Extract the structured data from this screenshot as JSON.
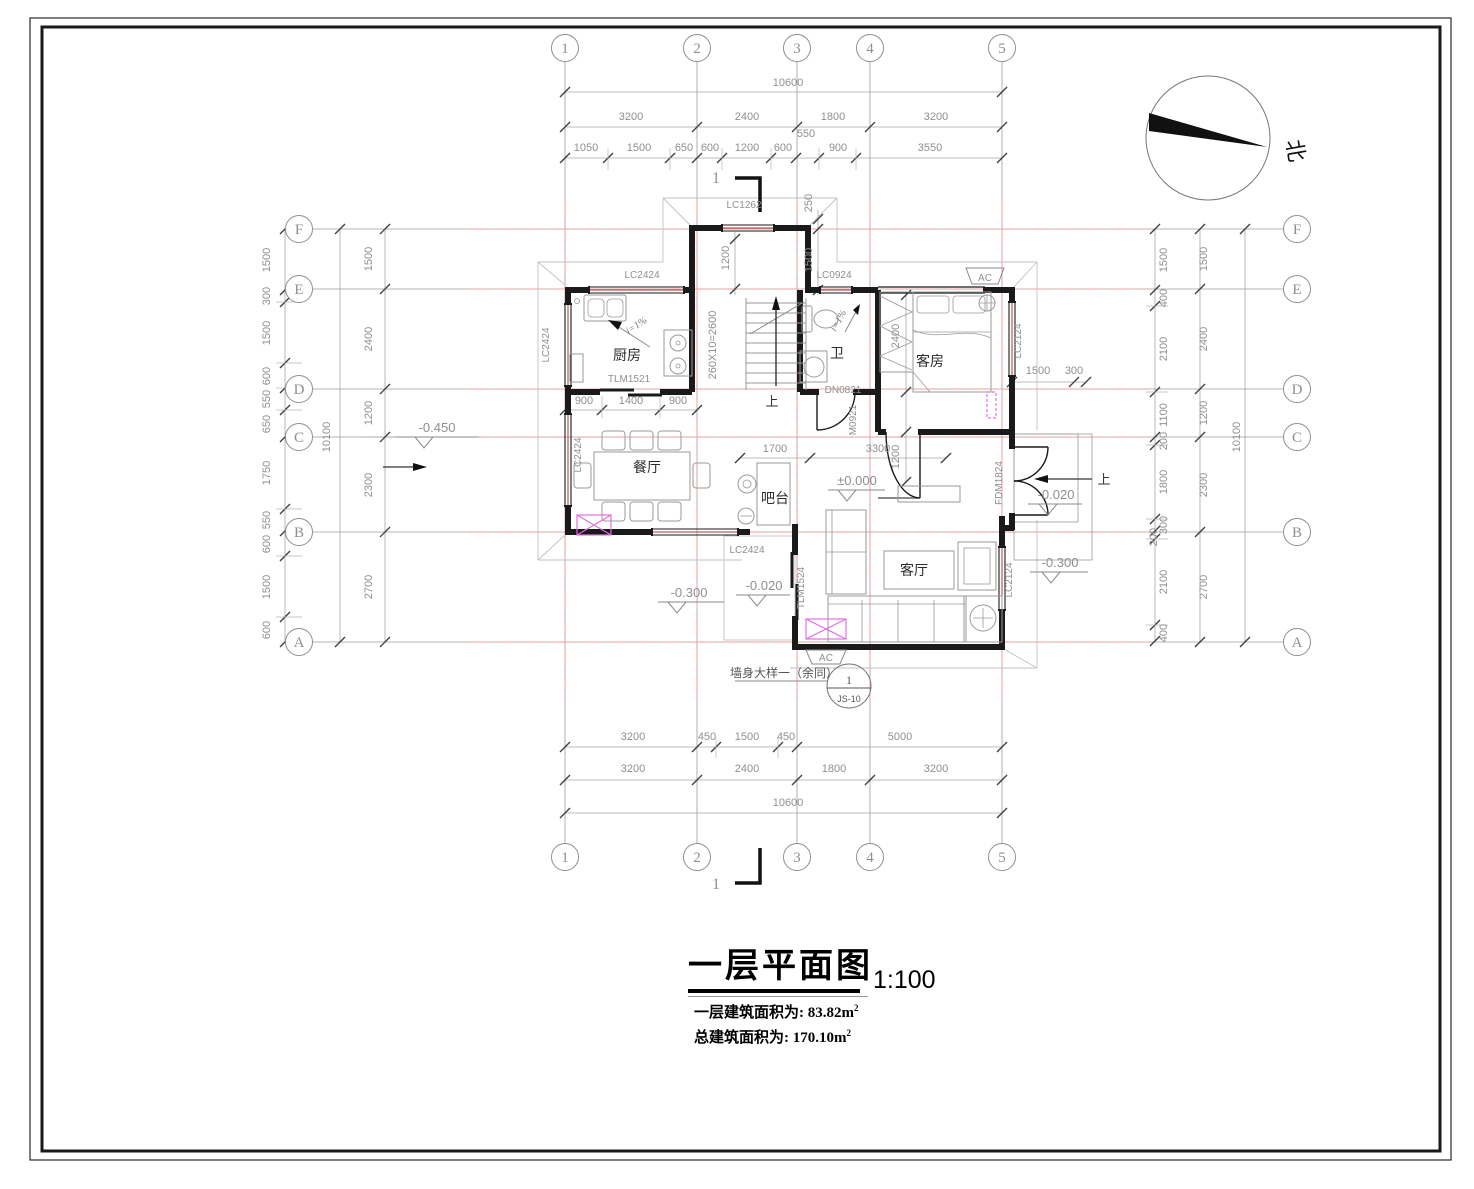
{
  "title_block": {
    "title": "一层平面图",
    "scale": "1:100",
    "area1_label": "一层建筑面积为: 83.82m",
    "area1_sup": "2",
    "area2_label": "总建筑面积为: 170.10m",
    "area2_sup": "2"
  },
  "north": {
    "label": "北"
  },
  "grid": {
    "top": [
      "1",
      "2",
      "3",
      "4",
      "5"
    ],
    "bottom": [
      "1",
      "2",
      "3",
      "4",
      "5"
    ],
    "left": [
      "F",
      "E",
      "D",
      "C",
      "B",
      "A"
    ],
    "right": [
      "F",
      "E",
      "D",
      "C",
      "B",
      "A"
    ]
  },
  "dims": {
    "top_total": "10600",
    "top_major": [
      "3200",
      "2400",
      "1800",
      "3200"
    ],
    "top_fine": [
      "1050",
      "1500",
      "650",
      "600",
      "1200",
      "600",
      "900",
      "3550"
    ],
    "top_550": "550",
    "top_v": [
      "250",
      "1200",
      "1500"
    ],
    "bottom_fine": [
      "3200",
      "450",
      "1500",
      "450",
      "5000"
    ],
    "bottom_major": [
      "3200",
      "2400",
      "1800",
      "3200"
    ],
    "bottom_total": "10600",
    "left_fine": [
      "1500",
      "300",
      "1500",
      "600",
      "550",
      "650",
      "1750",
      "550",
      "600",
      "1500",
      "600"
    ],
    "left_major": [
      "1500",
      "2400",
      "1200",
      "2300",
      "2700"
    ],
    "left_total": "10100",
    "right_fine": [
      "1500",
      "400",
      "2100",
      "1100",
      "200",
      "1800",
      "300",
      "200",
      "2100",
      "400"
    ],
    "right_major": [
      "1500",
      "2400",
      "1200",
      "2300",
      "2700"
    ],
    "right_total": "10100",
    "kitchen": [
      "900",
      "1400",
      "900"
    ],
    "hall": [
      "1700",
      "3300"
    ],
    "guest_right": [
      "1500",
      "300"
    ],
    "guest_v": [
      "2400",
      "1200"
    ],
    "stair": "260X10=2600"
  },
  "rooms": {
    "kitchen": "厨房",
    "dining": "餐厅",
    "bar": "吧台",
    "bath": "卫",
    "guest": "客房",
    "living": "客厅"
  },
  "openings": {
    "lc2424": "LC2424",
    "lc1262": "LC1262",
    "lc0924": "LC0924",
    "lc2124": "LC2124",
    "tlm1521": "TLM1521",
    "tlm1524": "TLM1524",
    "fdm1824": "FDM1824",
    "dn0821": "DN0821",
    "m0921": "M0921",
    "ac": "AC"
  },
  "levels": {
    "l450": "-0.450",
    "l000": "±0.000",
    "l020": "-0.020",
    "l300": "-0.300"
  },
  "slope": "i=1%",
  "stair_up": "上",
  "section": {
    "num": "1"
  },
  "callout": {
    "text": "墙身大样一（余同）",
    "num": "1",
    "sheet": "JS-10"
  }
}
